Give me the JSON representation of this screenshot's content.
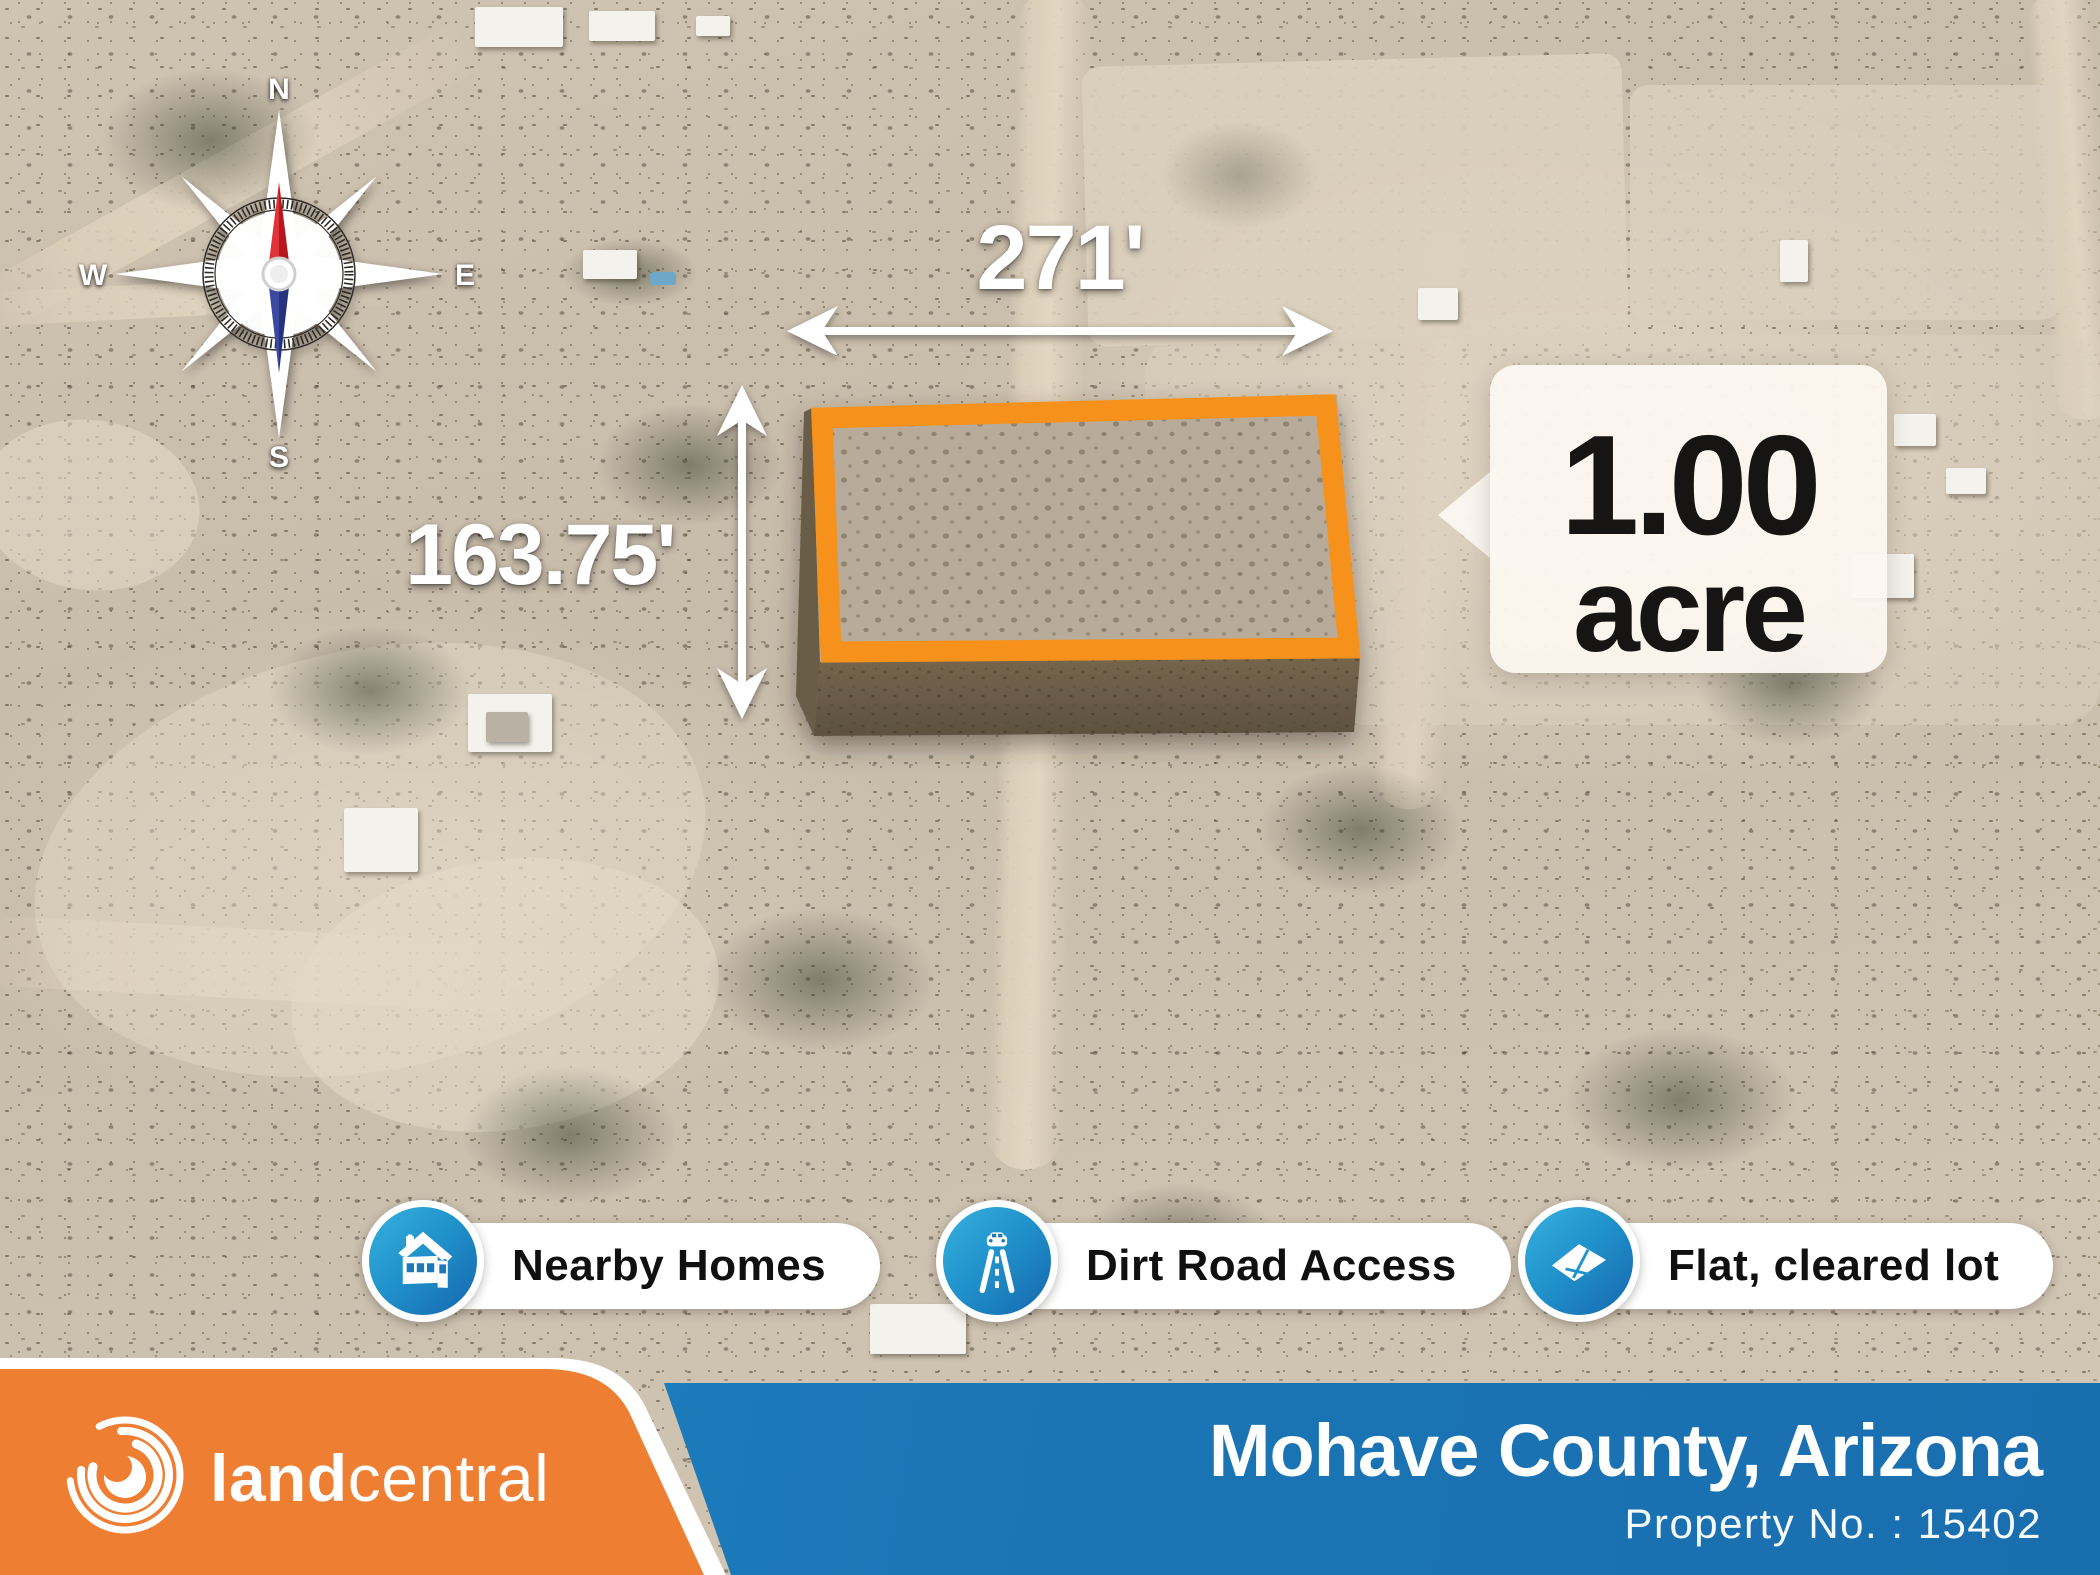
{
  "map": {
    "compass": {
      "n": "N",
      "e": "E",
      "s": "S",
      "w": "W"
    },
    "dimensions": {
      "width_label": "271'",
      "height_label": "163.75'"
    },
    "acreage": {
      "value": "1.00",
      "unit": "acre"
    }
  },
  "features": [
    {
      "icon": "house-icon",
      "label": "Nearby Homes"
    },
    {
      "icon": "road-icon",
      "label": "Dirt Road Access"
    },
    {
      "icon": "flat-lot-icon",
      "label": "Flat, cleared lot"
    }
  ],
  "footer": {
    "brand_bold": "land",
    "brand_light": "central",
    "location": "Mohave County, Arizona",
    "property_no": "Property No. : 15402"
  },
  "colors": {
    "parcel_outline_orange": "#f6921e",
    "footer_orange": "#ee7e31",
    "footer_blue": "#1b76b6",
    "badge_blue_from": "#38b1de",
    "badge_blue_to": "#1667ae",
    "needle_red": "#d42127",
    "needle_blue": "#2d3e92"
  }
}
